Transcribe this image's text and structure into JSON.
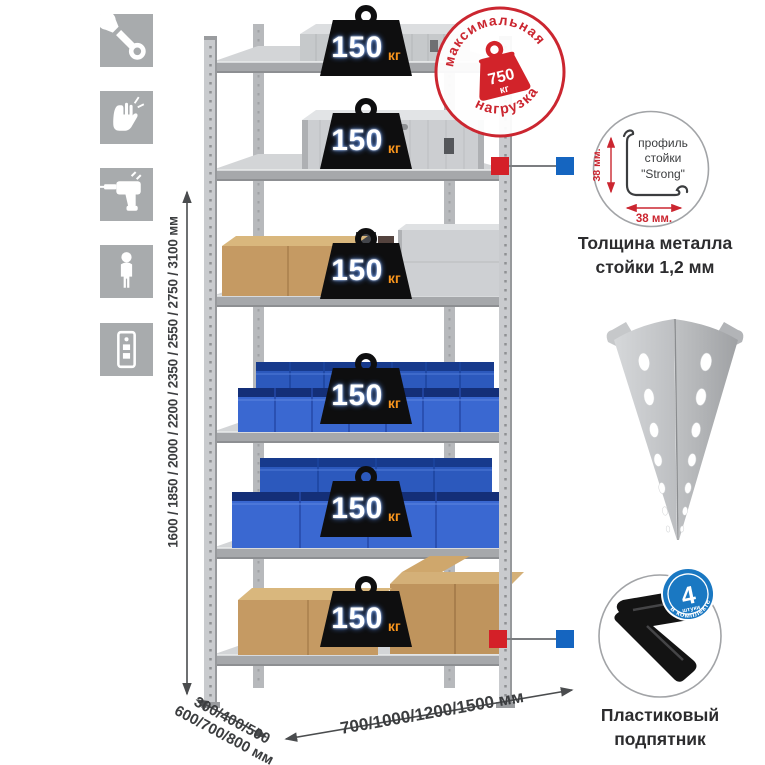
{
  "page": {
    "background": "#ffffff"
  },
  "features": {
    "icons": [
      {
        "name": "wrench"
      },
      {
        "name": "gloves"
      },
      {
        "name": "drill"
      },
      {
        "name": "person"
      },
      {
        "name": "rack-unit"
      }
    ]
  },
  "rack": {
    "shelf_count": 6,
    "shelves": [
      {
        "load_value": "150",
        "load_unit": "кг"
      },
      {
        "load_value": "150",
        "load_unit": "кг"
      },
      {
        "load_value": "150",
        "load_unit": "кг"
      },
      {
        "load_value": "150",
        "load_unit": "кг"
      },
      {
        "load_value": "150",
        "load_unit": "кг"
      },
      {
        "load_value": "150",
        "load_unit": "кг"
      }
    ]
  },
  "stamp": {
    "top_text": "максимальная",
    "bottom_text": "нагрузка",
    "value": "750",
    "unit": "кг"
  },
  "dimensions": {
    "height": "1600 / 1850 / 2000 / 2200 / 2350 / 2550 / 2750 / 3100 мм",
    "depth_line1": "300/400/500",
    "depth_line2": "600/700/800 мм",
    "width": "700/1000/1200/1500 мм"
  },
  "profile_callout": {
    "label_line1": "профиль",
    "label_line2": "стойки",
    "label_line3": "\"Strong\"",
    "dim_vertical": "38 мм.",
    "dim_horizontal": "38 мм.",
    "caption_line1": "Толщина металла",
    "caption_line2": "стойки 1,2 мм"
  },
  "foot_callout": {
    "badge_number": "4",
    "badge_word": "штуки",
    "badge_arc": "в комплекте",
    "caption_line1": "Пластиковый",
    "caption_line2": "подпятник"
  },
  "colors": {
    "stamp_red": "#cb2630",
    "load_unit_orange": "#f7941d",
    "bin_blue": "#2e5fc6",
    "badge_blue": "#1a78c2",
    "connector_red": "#d42028",
    "connector_blue": "#1565c0",
    "metal_light": "#cdd0d3",
    "metal_mid": "#b7b9bc",
    "cardboard": "#c59a63",
    "icon_tile_gray": "#a8abad",
    "dim_text": "#3b3d3f"
  }
}
